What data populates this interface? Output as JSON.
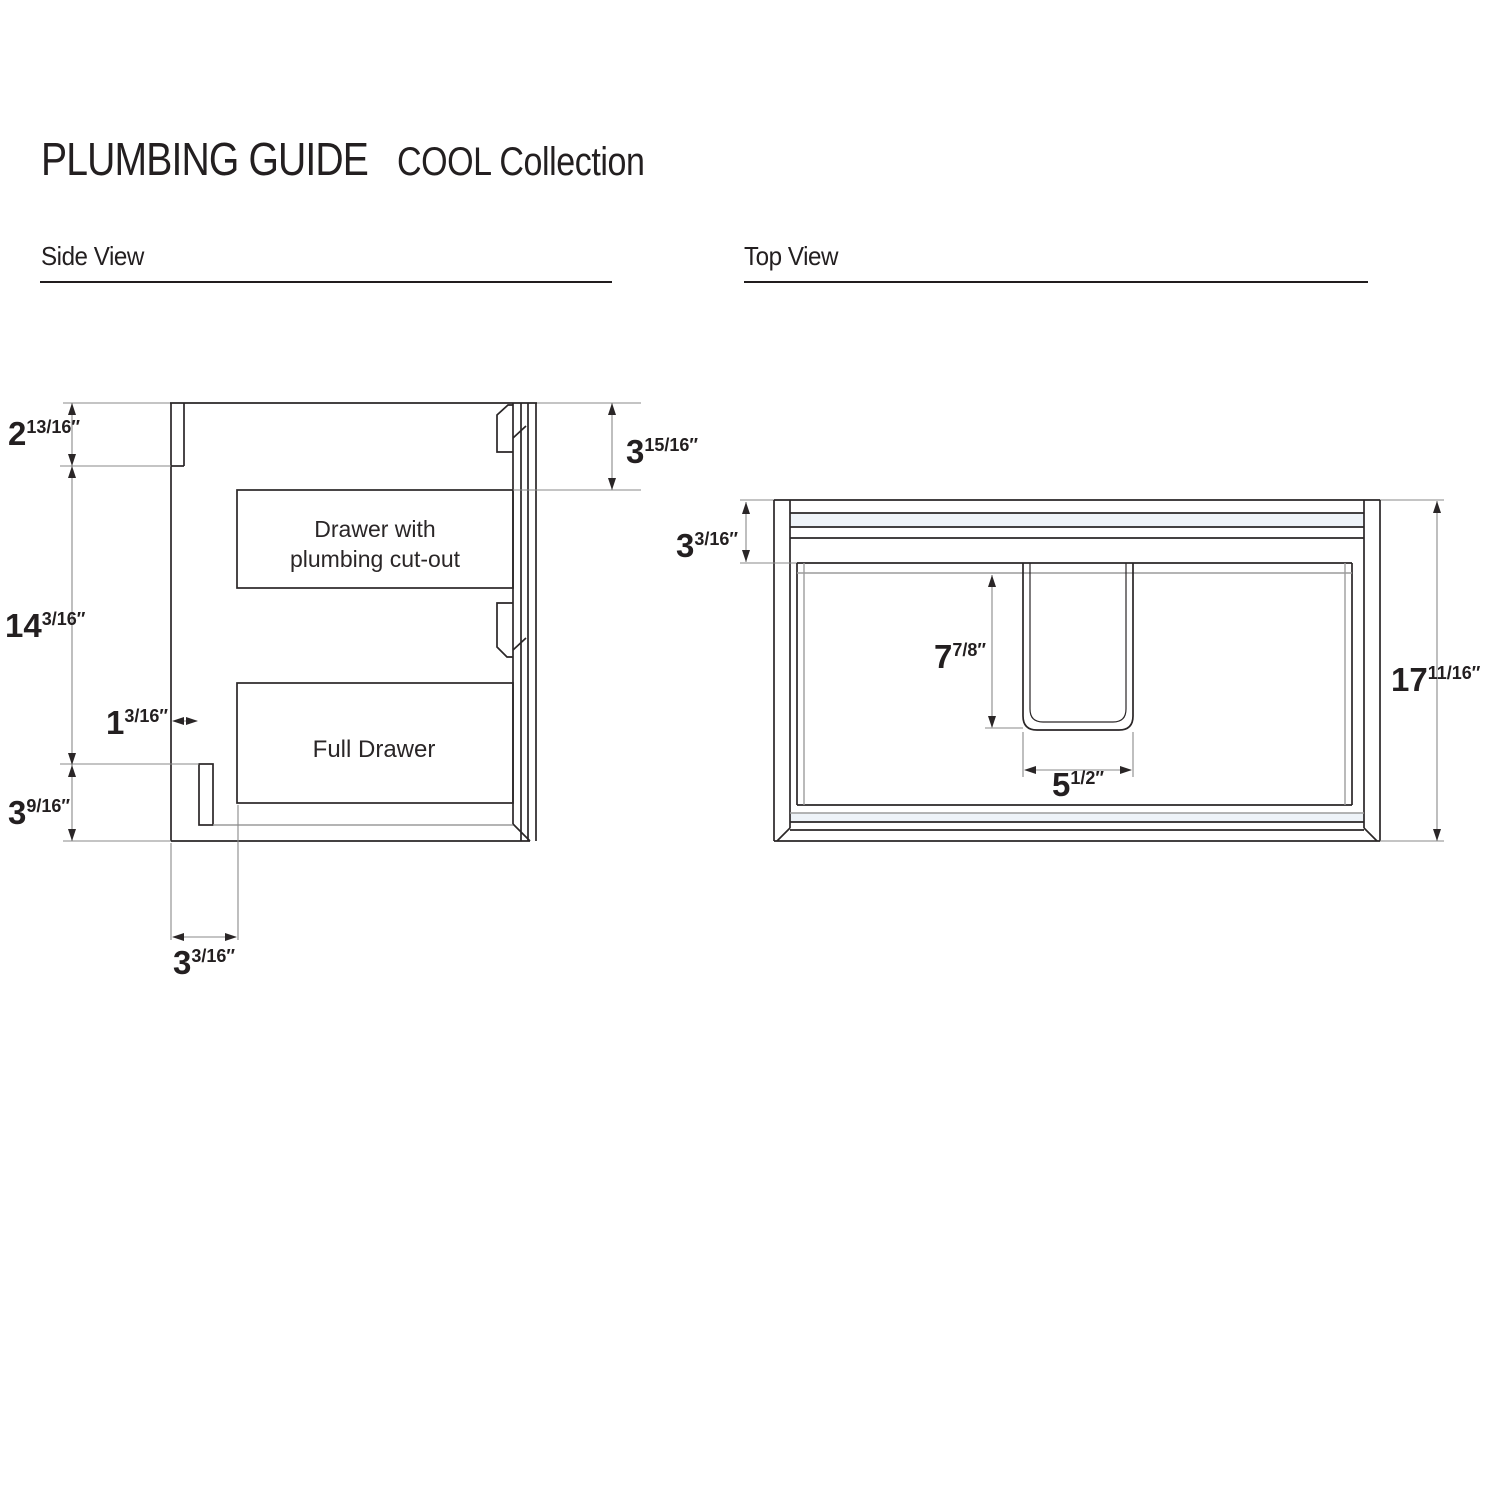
{
  "header": {
    "title": "PLUMBING GUIDE",
    "subtitle": "COOL Collection"
  },
  "sections": {
    "side": {
      "label": "Side View"
    },
    "top": {
      "label": "Top View"
    }
  },
  "side_view": {
    "drawer_top_label_line1": "Drawer with",
    "drawer_top_label_line2": "plumbing cut-out",
    "drawer_bottom_label": "Full Drawer",
    "dims": {
      "bracket_height": {
        "whole": "2",
        "frac": "13/16″"
      },
      "cabinet_height": {
        "whole": "14",
        "frac": "3/16″"
      },
      "bottom_clearance": {
        "whole": "3",
        "frac": "9/16″"
      },
      "ledger_offset": {
        "whole": "1",
        "frac": "3/16″"
      },
      "back_inset": {
        "whole": "3",
        "frac": "3/16″"
      },
      "top_drawer_offset": {
        "whole": "3",
        "frac": "15/16″"
      }
    }
  },
  "top_view": {
    "dims": {
      "back_rail_depth": {
        "whole": "3",
        "frac": "3/16″"
      },
      "cutout_depth": {
        "whole": "7",
        "frac": "7/8″"
      },
      "cutout_width": {
        "whole": "5",
        "frac": "1/2″"
      },
      "cabinet_depth": {
        "whole": "17",
        "frac": "11/16″"
      }
    }
  },
  "colors": {
    "line": "#2a2627",
    "gray": "#9c9c9c",
    "dim_line": "#8a8a8a",
    "text": "#231f20",
    "tint": "#eef3f8"
  }
}
